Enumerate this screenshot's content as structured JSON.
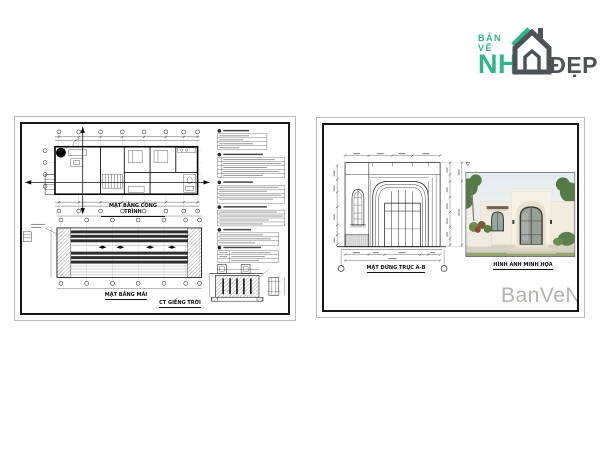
{
  "brand": {
    "top_text": "BẢN VẼ",
    "main_text": "NH",
    "suffix_text": "ĐẸP",
    "green": "#2fb487",
    "dark_gray": "#4d5256",
    "icon": "house-icon"
  },
  "left_sheet": {
    "description": "cad-sheet-plans",
    "captions": {
      "floor_plan": "MẶT BẰNG CÔNG TRÌNH",
      "roof_plan": "MẶT BẰNG MÁI",
      "skylight_detail": "CT GIẾNG TRỜI"
    }
  },
  "right_sheet": {
    "description": "cad-sheet-elevation",
    "captions": {
      "elevation": "MẶT ĐỨNG TRỤC A-B",
      "photo": "HÌNH ẢNH MINH HỌA"
    },
    "watermark": "BanVeNha"
  },
  "colors": {
    "sheet_border": "#b8b8b8",
    "frame": "#161616",
    "watermark_gray": "#b3b2af",
    "background": "#ffffff"
  }
}
